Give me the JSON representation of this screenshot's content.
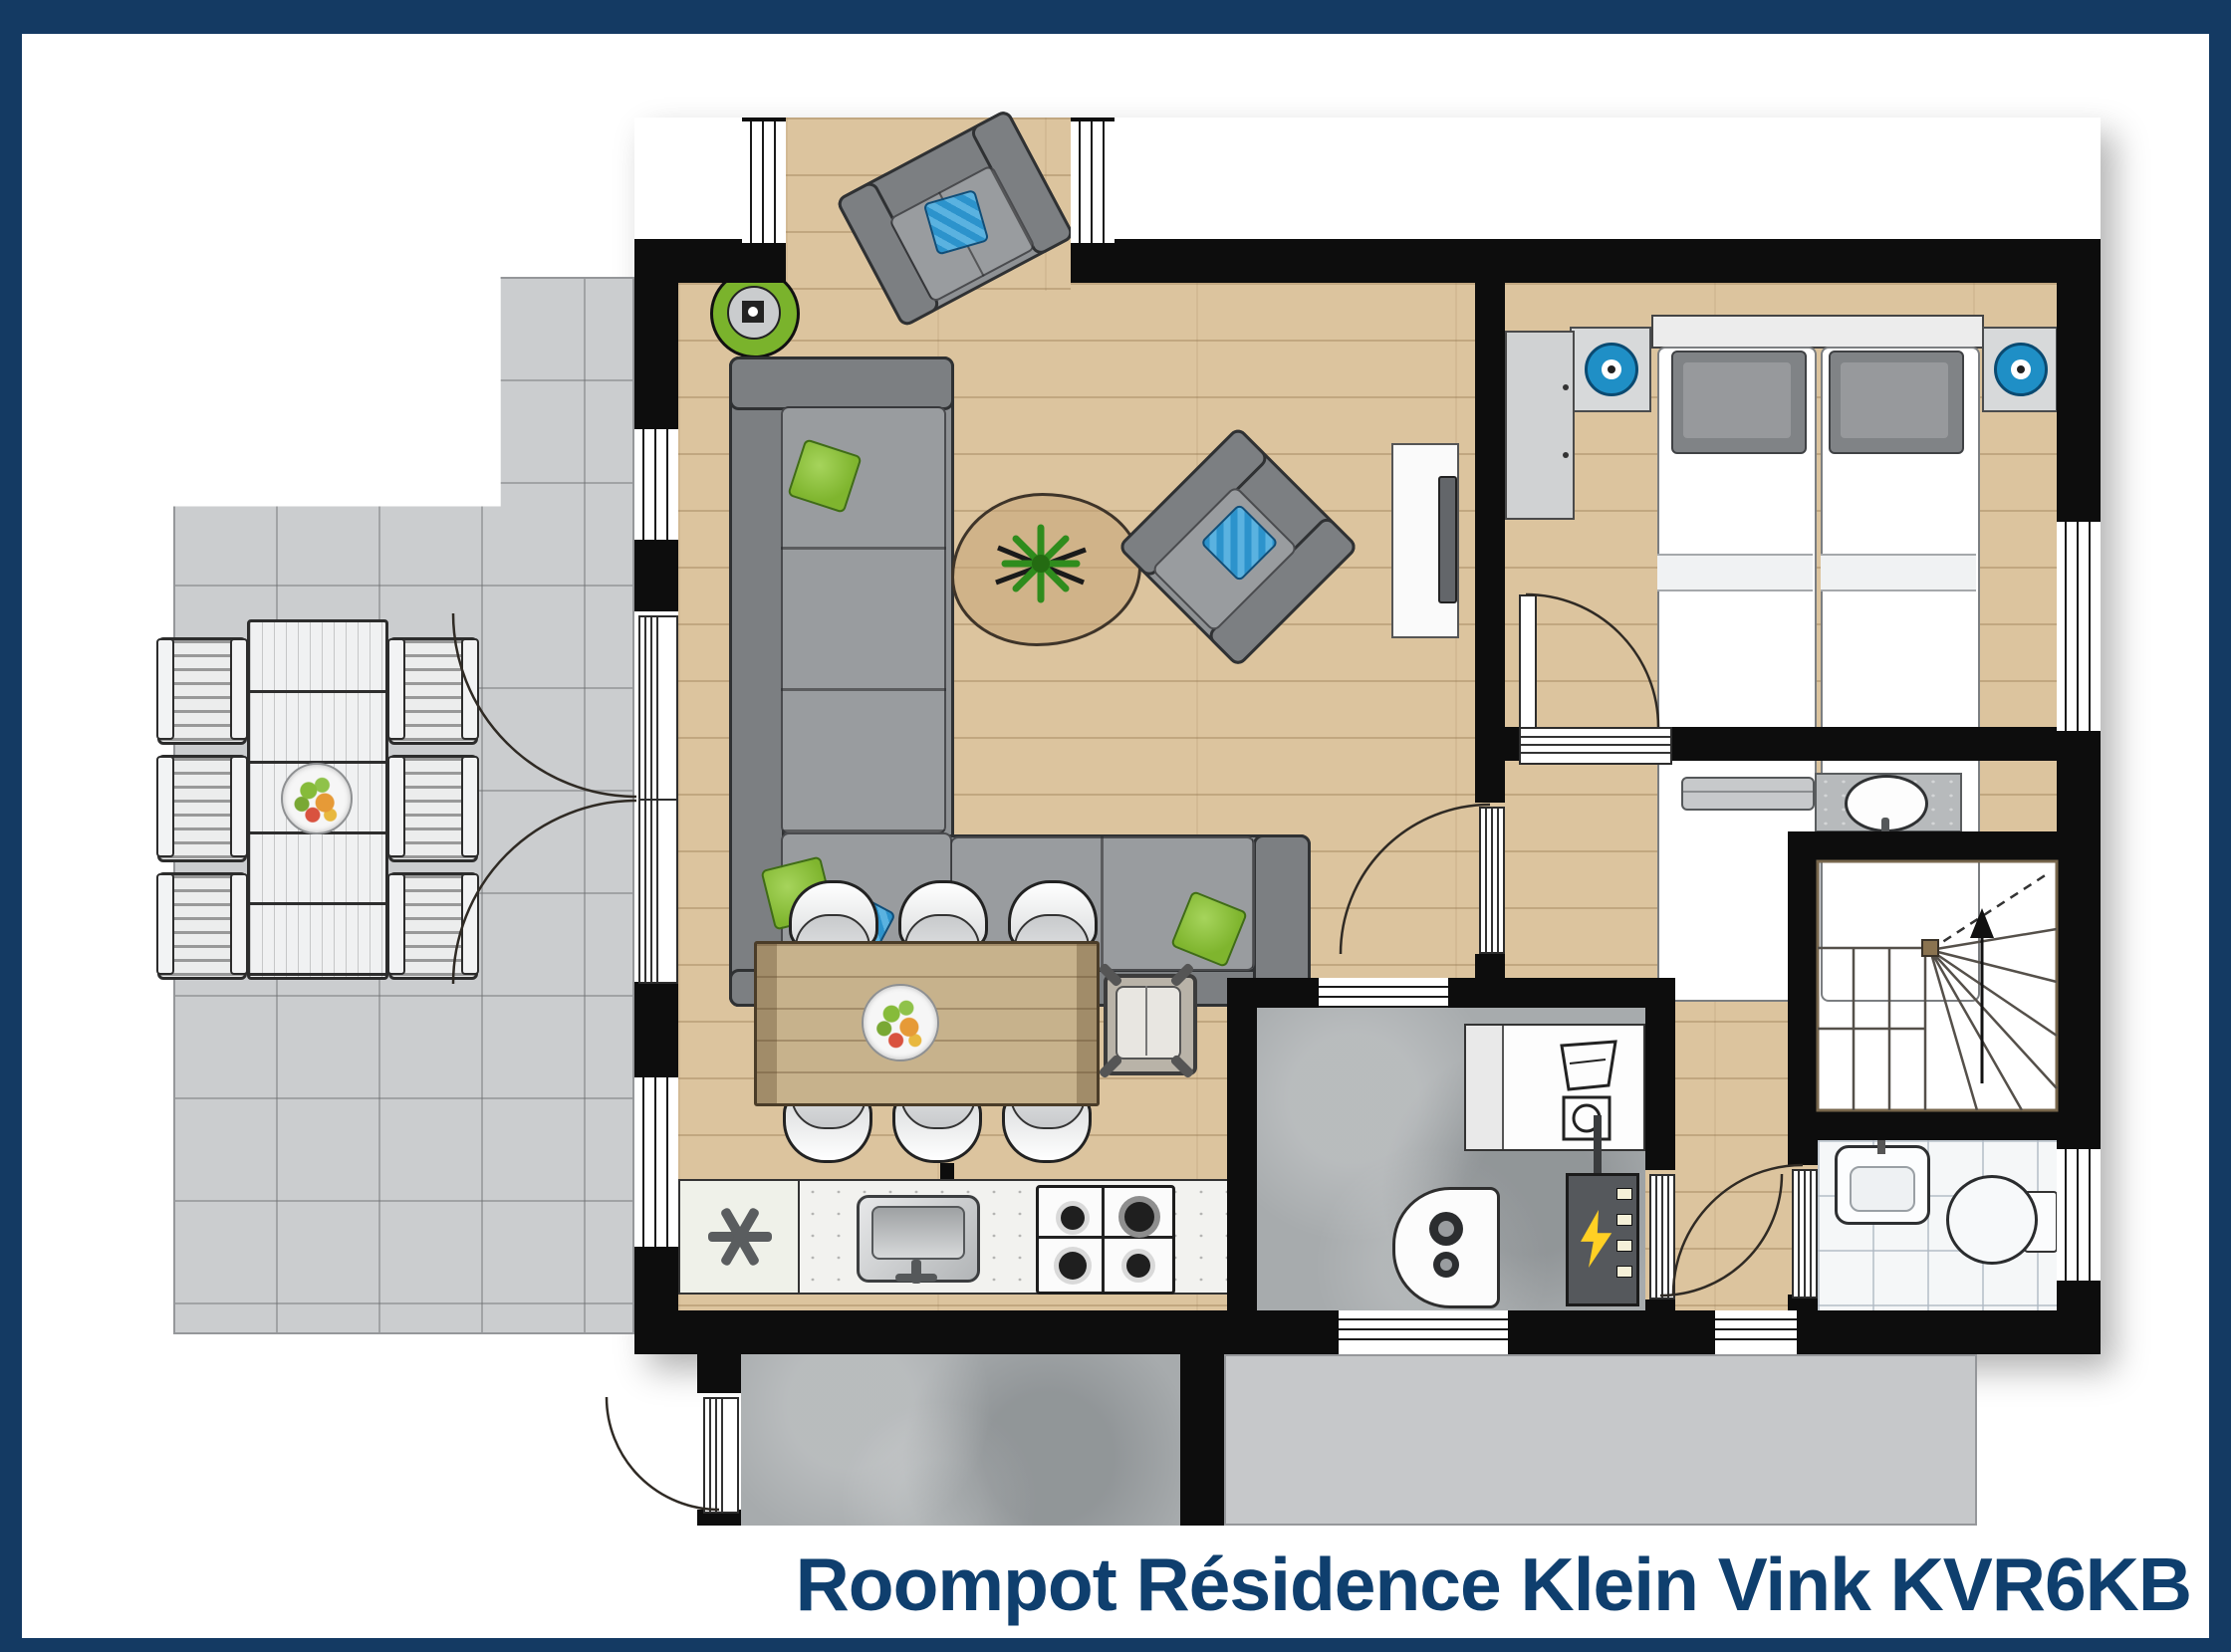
{
  "title": {
    "text": "Roompot Résidence Klein Vink KVR6KB"
  },
  "colors": {
    "frame_navy": "#143a63",
    "title_navy": "#0f3f6e",
    "wall_black": "#0d0d0d",
    "wood_floor": "#dcc49e",
    "terrace_tile": "#cbcdcf",
    "bathroom_tile": "#f5f7f8",
    "concrete_gray": "#a7abad",
    "accent_green": "#7ab32c",
    "accent_blue": "#2e9bd6"
  },
  "rooms": [
    "terrace",
    "living-room",
    "dining-area",
    "kitchen",
    "bedroom",
    "hallway",
    "staircase",
    "bathroom",
    "utility-room",
    "storage-room",
    "patio"
  ],
  "furniture": [
    "corner-sofa",
    "bay-sofa",
    "armchair",
    "coffee-table",
    "plant",
    "round-floor-lamp",
    "tv-cabinet",
    "tv",
    "dining-table",
    "dining-chairs",
    "high-chair",
    "fruit-bowl",
    "freezer-cabinet",
    "kitchen-sink",
    "gas-hob",
    "double-bed",
    "pillows",
    "nightstands",
    "speakers",
    "wardrobe",
    "washbasin-vanity",
    "radiator",
    "hand-basin",
    "toilet",
    "washer-dryer",
    "boiler",
    "fuse-box",
    "outdoor-table",
    "outdoor-chairs"
  ],
  "icons": [
    "freezer-asterisk-icon",
    "lightning-icon",
    "washer-icon",
    "dryer-icon",
    "stairs-up-arrow-icon",
    "speaker-icon"
  ]
}
